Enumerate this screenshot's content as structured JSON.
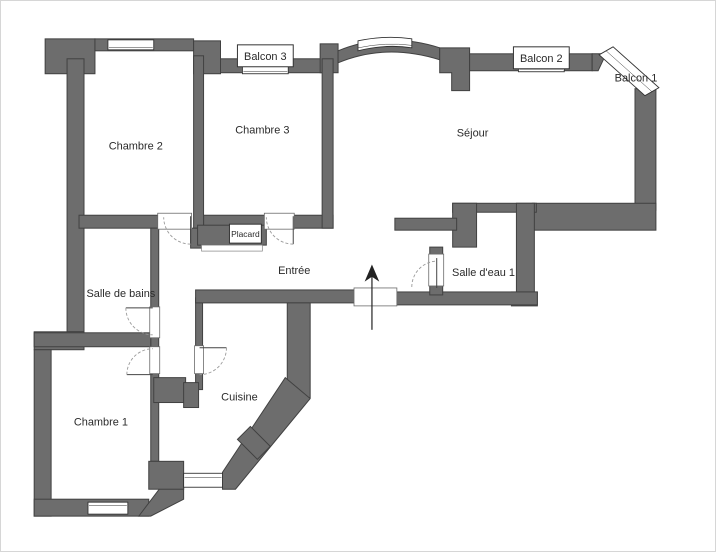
{
  "plan": {
    "labels": {
      "chambre1": "Chambre 1",
      "chambre2": "Chambre 2",
      "chambre3": "Chambre 3",
      "sejour": "Séjour",
      "cuisine": "Cuisine",
      "salle_de_bains": "Salle de bains",
      "salle_deau_1": "Salle d'eau 1",
      "entree": "Entrée",
      "placard": "Placard",
      "balcon1": "Balcon 1",
      "balcon2": "Balcon 2",
      "balcon3": "Balcon 3"
    },
    "icons": {
      "north_arrow": "north-arrow"
    },
    "colors": {
      "wall": "#6d6d6d",
      "wall_outline": "#414141",
      "background": "#ffffff",
      "text": "#2a2a2a"
    }
  }
}
